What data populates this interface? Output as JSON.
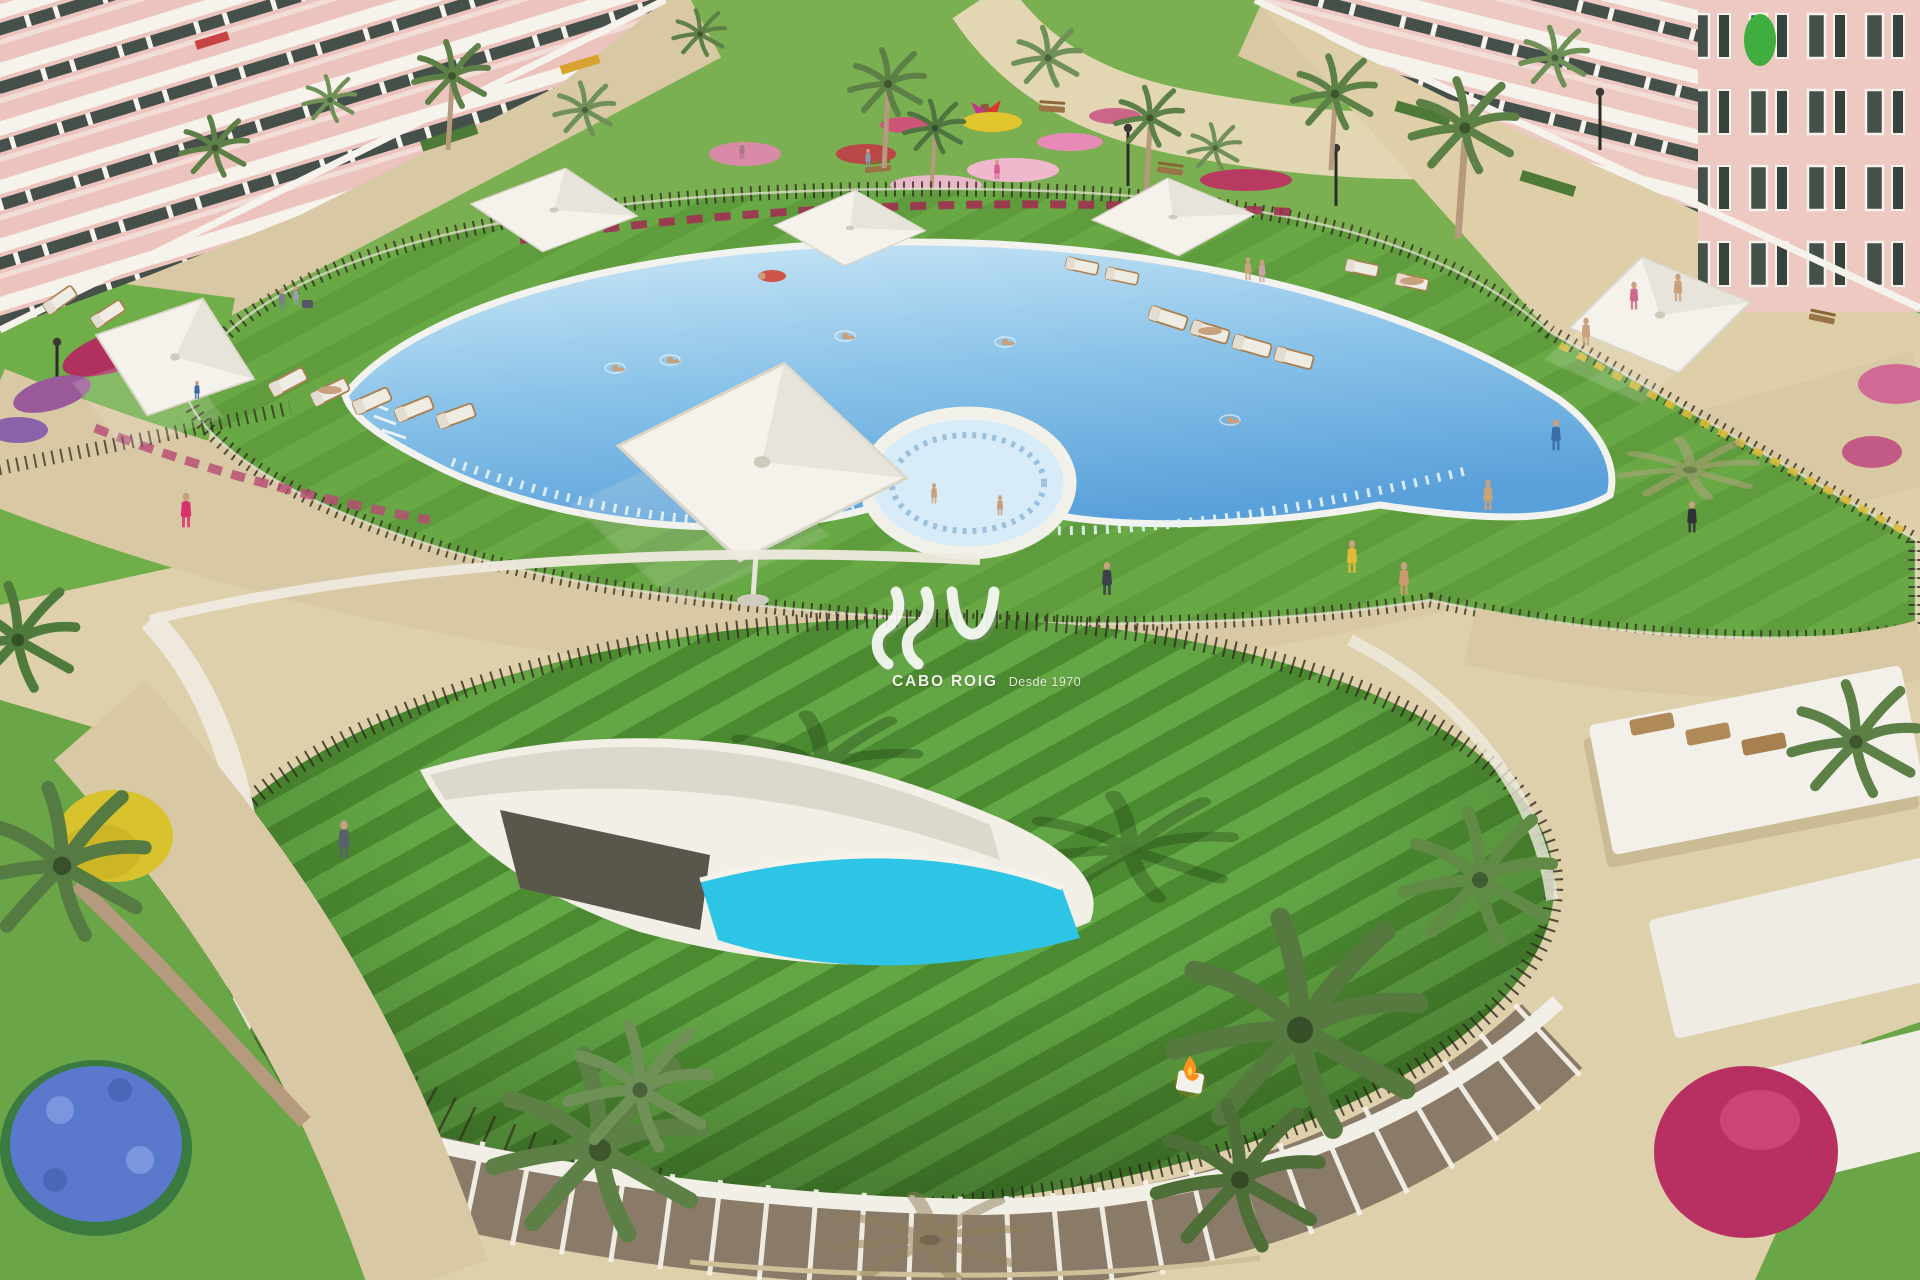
{
  "watermark": {
    "monogram": "AV",
    "brand": "CABO ROIG",
    "tagline": "Desde 1970"
  },
  "colors": {
    "sand": "#ddd0ab",
    "sand-light": "#decfa9",
    "path": "#d8c8a3",
    "lawn-park": "#7bb052",
    "lawn-deck": "#68a946",
    "mound-stripe-a": "#4c8a31",
    "mound-stripe-b": "#63a645",
    "pool-shallow": "#cfe9f7",
    "pool-deep": "#5aa0da",
    "pool-rim": "#f2f2ee",
    "spa-water": "#d7ecf8",
    "plunge-pool": "#2ec4e6",
    "fence": "#332c1e",
    "building-pink": "#ecc4bd",
    "balcony-white": "#f6f3ed",
    "window-dark": "#46504b",
    "palm-green": "#5d8046",
    "trunk": "#b59a7e",
    "flower-magenta": "#b82f62",
    "flower-pink": "#e48ab4",
    "flower-yellow": "#d8c22e",
    "flower-blue": "#5b79cc",
    "parasol": "#f4f2ea",
    "lounger-pad": "#efece4",
    "lounger-wood": "#a97f4f",
    "skin": "#c9a07d",
    "fire": "#ff9020",
    "wall-white": "#efeadf",
    "glass-brown": "#8a7b69"
  }
}
